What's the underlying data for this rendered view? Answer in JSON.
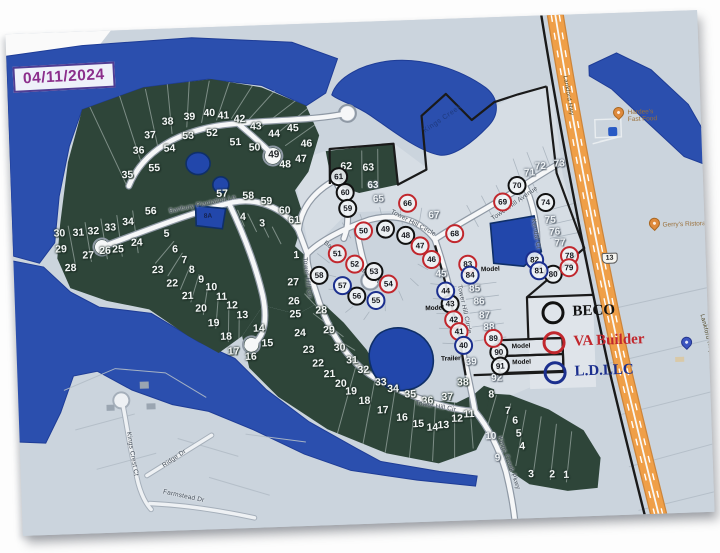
{
  "map": {
    "date_stamp": "04/11/2024",
    "colors": {
      "water": "#2b4fae",
      "forest": "#2e4539",
      "plat_light": "#d6dde4",
      "base": "#cbd4dd",
      "road": "#f6f7f8",
      "highway_orange": "#ef9f48",
      "boundary_black": "#1a1a1a",
      "beco": "#111111",
      "va_builder": "#c1272d",
      "ld_llc": "#1b2f8e",
      "date_stamp": "#8b2e8c"
    },
    "legend_colors": {
      "BECO": "#111111",
      "VA": "#c1272d",
      "LD": "#1b2f8e"
    },
    "legend_items": [
      {
        "label": "BECO",
        "color": "#111111"
      },
      {
        "label": "VA Builder",
        "color": "#c1272d"
      },
      {
        "label": "L.D.LLC",
        "color": "#1b2f8e"
      }
    ],
    "lot_labels": [
      {
        "n": "35",
        "x": 131,
        "y": 167
      },
      {
        "n": "36",
        "x": 143,
        "y": 143
      },
      {
        "n": "37",
        "x": 155,
        "y": 128
      },
      {
        "n": "38",
        "x": 173,
        "y": 115
      },
      {
        "n": "39",
        "x": 195,
        "y": 111
      },
      {
        "n": "40",
        "x": 215,
        "y": 108
      },
      {
        "n": "41",
        "x": 229,
        "y": 111
      },
      {
        "n": "42",
        "x": 245,
        "y": 115
      },
      {
        "n": "43",
        "x": 261,
        "y": 123
      },
      {
        "n": "44",
        "x": 279,
        "y": 131
      },
      {
        "n": "45",
        "x": 298,
        "y": 126
      },
      {
        "n": "46",
        "x": 311,
        "y": 142
      },
      {
        "n": "47",
        "x": 305,
        "y": 157
      },
      {
        "n": "48",
        "x": 289,
        "y": 162
      },
      {
        "n": "49",
        "x": 278,
        "y": 152,
        "cls": "dark"
      },
      {
        "n": "50",
        "x": 259,
        "y": 144
      },
      {
        "n": "51",
        "x": 240,
        "y": 138
      },
      {
        "n": "52",
        "x": 217,
        "y": 128
      },
      {
        "n": "53",
        "x": 193,
        "y": 130
      },
      {
        "n": "54",
        "x": 174,
        "y": 142
      },
      {
        "n": "55",
        "x": 158,
        "y": 161
      },
      {
        "n": "56",
        "x": 153,
        "y": 204
      },
      {
        "n": "57",
        "x": 225,
        "y": 189
      },
      {
        "n": "58",
        "x": 251,
        "y": 192
      },
      {
        "n": "59",
        "x": 269,
        "y": 198
      },
      {
        "n": "60",
        "x": 287,
        "y": 208
      },
      {
        "n": "61",
        "x": 296,
        "y": 218
      },
      {
        "n": "62",
        "x": 350,
        "y": 166
      },
      {
        "n": "63",
        "x": 372,
        "y": 168
      },
      {
        "n": "4",
        "x": 245,
        "y": 213
      },
      {
        "n": "3",
        "x": 264,
        "y": 220
      },
      {
        "n": "30",
        "x": 61,
        "y": 223
      },
      {
        "n": "31",
        "x": 80,
        "y": 223
      },
      {
        "n": "32",
        "x": 95,
        "y": 222
      },
      {
        "n": "33",
        "x": 112,
        "y": 219
      },
      {
        "n": "34",
        "x": 130,
        "y": 214
      },
      {
        "n": "29",
        "x": 62,
        "y": 239
      },
      {
        "n": "28",
        "x": 71,
        "y": 258
      },
      {
        "n": "27",
        "x": 89,
        "y": 246
      },
      {
        "n": "26",
        "x": 106,
        "y": 242
      },
      {
        "n": "25",
        "x": 119,
        "y": 241
      },
      {
        "n": "24",
        "x": 138,
        "y": 235
      },
      {
        "n": "5",
        "x": 168,
        "y": 227
      },
      {
        "n": "6",
        "x": 176,
        "y": 243
      },
      {
        "n": "7",
        "x": 185,
        "y": 254
      },
      {
        "n": "8",
        "x": 192,
        "y": 264
      },
      {
        "n": "9",
        "x": 201,
        "y": 274
      },
      {
        "n": "10",
        "x": 211,
        "y": 282
      },
      {
        "n": "11",
        "x": 221,
        "y": 292
      },
      {
        "n": "12",
        "x": 231,
        "y": 301
      },
      {
        "n": "13",
        "x": 241,
        "y": 311
      },
      {
        "n": "14",
        "x": 257,
        "y": 325
      },
      {
        "n": "15",
        "x": 265,
        "y": 340
      },
      {
        "n": "16",
        "x": 248,
        "y": 353
      },
      {
        "n": "23",
        "x": 158,
        "y": 263
      },
      {
        "n": "22",
        "x": 172,
        "y": 277
      },
      {
        "n": "21",
        "x": 187,
        "y": 290
      },
      {
        "n": "20",
        "x": 200,
        "y": 303
      },
      {
        "n": "19",
        "x": 212,
        "y": 318
      },
      {
        "n": "18",
        "x": 224,
        "y": 332
      },
      {
        "n": "17",
        "x": 231,
        "y": 347
      },
      {
        "n": "1",
        "x": 297,
        "y": 253
      },
      {
        "n": "27",
        "x": 293,
        "y": 280
      },
      {
        "n": "26",
        "x": 293,
        "y": 299
      },
      {
        "n": "25",
        "x": 294,
        "y": 312
      },
      {
        "n": "24",
        "x": 298,
        "y": 331
      },
      {
        "n": "23",
        "x": 306,
        "y": 348
      },
      {
        "n": "22",
        "x": 315,
        "y": 362
      },
      {
        "n": "21",
        "x": 326,
        "y": 373
      },
      {
        "n": "20",
        "x": 337,
        "y": 383
      },
      {
        "n": "19",
        "x": 347,
        "y": 391
      },
      {
        "n": "28",
        "x": 320,
        "y": 309
      },
      {
        "n": "29",
        "x": 327,
        "y": 329
      },
      {
        "n": "30",
        "x": 337,
        "y": 347
      },
      {
        "n": "31",
        "x": 349,
        "y": 360
      },
      {
        "n": "32",
        "x": 360,
        "y": 370
      },
      {
        "n": "33",
        "x": 377,
        "y": 383
      },
      {
        "n": "34",
        "x": 389,
        "y": 390
      },
      {
        "n": "35",
        "x": 406,
        "y": 396
      },
      {
        "n": "36",
        "x": 423,
        "y": 403
      },
      {
        "n": "37",
        "x": 443,
        "y": 400
      },
      {
        "n": "38",
        "x": 459,
        "y": 386
      },
      {
        "n": "18",
        "x": 360,
        "y": 401
      },
      {
        "n": "17",
        "x": 378,
        "y": 411
      },
      {
        "n": "16",
        "x": 397,
        "y": 419
      },
      {
        "n": "15",
        "x": 413,
        "y": 426
      },
      {
        "n": "14",
        "x": 427,
        "y": 430
      },
      {
        "n": "13",
        "x": 438,
        "y": 428
      },
      {
        "n": "12",
        "x": 452,
        "y": 422
      },
      {
        "n": "11",
        "x": 464,
        "y": 418
      },
      {
        "n": "63",
        "x": 376,
        "y": 186,
        "cls": "lt"
      },
      {
        "n": "65",
        "x": 381,
        "y": 200,
        "cls": "lt"
      },
      {
        "n": "67",
        "x": 436,
        "y": 218,
        "cls": "lt"
      },
      {
        "n": "45",
        "x": 441,
        "y": 277,
        "cls": "lt"
      },
      {
        "n": "71",
        "x": 533,
        "y": 179,
        "cls": "lt"
      },
      {
        "n": "72",
        "x": 544,
        "y": 173,
        "cls": "lt"
      },
      {
        "n": "73",
        "x": 563,
        "y": 171,
        "cls": "lt"
      },
      {
        "n": "75",
        "x": 552,
        "y": 227,
        "cls": "lt"
      },
      {
        "n": "76",
        "x": 556,
        "y": 239,
        "cls": "lt"
      },
      {
        "n": "77",
        "x": 561,
        "y": 250,
        "cls": "lt"
      },
      {
        "n": "85",
        "x": 474,
        "y": 293,
        "cls": "lt"
      },
      {
        "n": "86",
        "x": 478,
        "y": 306,
        "cls": "lt"
      },
      {
        "n": "87",
        "x": 483,
        "y": 320,
        "cls": "lt"
      },
      {
        "n": "88",
        "x": 487,
        "y": 332,
        "cls": "lt"
      },
      {
        "n": "92",
        "x": 493,
        "y": 383,
        "cls": "lt"
      },
      {
        "n": "39",
        "x": 468,
        "y": 366,
        "cls": "lt"
      },
      {
        "n": "10",
        "x": 485,
        "y": 441,
        "cls": "lt"
      },
      {
        "n": "9",
        "x": 491,
        "y": 463,
        "cls": "lt"
      },
      {
        "n": "8",
        "x": 487,
        "y": 399
      },
      {
        "n": "7",
        "x": 503,
        "y": 416
      },
      {
        "n": "6",
        "x": 510,
        "y": 426
      },
      {
        "n": "5",
        "x": 513,
        "y": 439
      },
      {
        "n": "4",
        "x": 516,
        "y": 452
      },
      {
        "n": "3",
        "x": 524,
        "y": 480
      },
      {
        "n": "2",
        "x": 545,
        "y": 481
      },
      {
        "n": "1",
        "x": 559,
        "y": 482
      }
    ],
    "builder_circles": [
      {
        "b": "BECO",
        "n": "61",
        "x": 342,
        "y": 176
      },
      {
        "b": "BECO",
        "n": "60",
        "x": 348,
        "y": 192
      },
      {
        "b": "BECO",
        "n": "59",
        "x": 350,
        "y": 208
      },
      {
        "b": "BECO",
        "n": "49",
        "x": 387,
        "y": 230
      },
      {
        "b": "BECO",
        "n": "48",
        "x": 407,
        "y": 237
      },
      {
        "b": "BECO",
        "n": "58",
        "x": 319,
        "y": 274
      },
      {
        "b": "BECO",
        "n": "53",
        "x": 374,
        "y": 272
      },
      {
        "b": "BECO",
        "n": "56",
        "x": 356,
        "y": 296
      },
      {
        "b": "BECO",
        "n": "43",
        "x": 449,
        "y": 307
      },
      {
        "b": "BECO",
        "n": "70",
        "x": 520,
        "y": 191
      },
      {
        "b": "BECO",
        "n": "74",
        "x": 548,
        "y": 209
      },
      {
        "b": "BECO",
        "n": "80",
        "x": 553,
        "y": 281
      },
      {
        "b": "BECO",
        "n": "90",
        "x": 496,
        "y": 357
      },
      {
        "b": "BECO",
        "n": "91",
        "x": 497,
        "y": 371
      },
      {
        "b": "VA",
        "n": "50",
        "x": 365,
        "y": 231
      },
      {
        "b": "VA",
        "n": "47",
        "x": 421,
        "y": 248
      },
      {
        "b": "VA",
        "n": "46",
        "x": 432,
        "y": 262
      },
      {
        "b": "VA",
        "n": "51",
        "x": 338,
        "y": 253
      },
      {
        "b": "VA",
        "n": "52",
        "x": 355,
        "y": 264
      },
      {
        "b": "VA",
        "n": "54",
        "x": 388,
        "y": 285
      },
      {
        "b": "VA",
        "n": "66",
        "x": 410,
        "y": 205
      },
      {
        "b": "VA",
        "n": "68",
        "x": 456,
        "y": 237
      },
      {
        "b": "VA",
        "n": "69",
        "x": 505,
        "y": 207
      },
      {
        "b": "VA",
        "n": "83",
        "x": 468,
        "y": 268
      },
      {
        "b": "VA",
        "n": "42",
        "x": 452,
        "y": 323
      },
      {
        "b": "VA",
        "n": "41",
        "x": 457,
        "y": 335
      },
      {
        "b": "VA",
        "n": "89",
        "x": 491,
        "y": 343
      },
      {
        "b": "VA",
        "n": "78",
        "x": 570,
        "y": 263
      },
      {
        "b": "VA",
        "n": "79",
        "x": 569,
        "y": 275
      },
      {
        "b": "LD",
        "n": "57",
        "x": 342,
        "y": 285
      },
      {
        "b": "LD",
        "n": "55",
        "x": 375,
        "y": 301
      },
      {
        "b": "LD",
        "n": "84",
        "x": 470,
        "y": 279
      },
      {
        "b": "LD",
        "n": "44",
        "x": 445,
        "y": 294
      },
      {
        "b": "LD",
        "n": "40",
        "x": 461,
        "y": 349
      },
      {
        "b": "LD",
        "n": "82",
        "x": 535,
        "y": 266
      },
      {
        "b": "LD",
        "n": "81",
        "x": 539,
        "y": 277
      }
    ],
    "street_labels": [
      {
        "text": "Banbury Plantation Ln",
        "x": 205,
        "y": 199,
        "rot": -10
      },
      {
        "text": "Banbury Plantation Ct",
        "x": 352,
        "y": 262,
        "rot": 38
      },
      {
        "text": "Tower Hill Circle",
        "x": 415,
        "y": 225,
        "rot": 30
      },
      {
        "text": "Tower Hill Circle",
        "x": 463,
        "y": 313,
        "rot": 80
      },
      {
        "text": "Tower Hill Cir",
        "x": 307,
        "y": 276,
        "rot": 85
      },
      {
        "text": "Tower Hill Cir",
        "x": 431,
        "y": 409,
        "rot": 12
      },
      {
        "text": "Tower Hill Avenue",
        "x": 517,
        "y": 209,
        "rot": -33
      },
      {
        "text": "Kendal Ct",
        "x": 537,
        "y": 240,
        "rot": 82
      },
      {
        "text": "Kings Creek Pkwy",
        "x": 502,
        "y": 468,
        "rot": 72
      },
      {
        "text": "Kings Crest Ct",
        "x": 126,
        "y": 446,
        "rot": 82
      },
      {
        "text": "Ridge Dr",
        "x": 168,
        "y": 452,
        "rot": -32
      },
      {
        "text": "Farmstead Dr",
        "x": 176,
        "y": 490,
        "rot": 14
      }
    ],
    "notes": [
      {
        "text": "Model",
        "x": 481,
        "y": 274
      },
      {
        "text": "Model",
        "x": 424,
        "y": 311
      },
      {
        "text": "Model",
        "x": 509,
        "y": 352
      },
      {
        "text": "Model",
        "x": 509,
        "y": 368
      },
      {
        "text": "Trailer",
        "x": 438,
        "y": 362
      }
    ],
    "water_labels": [
      {
        "text": "Kings Creek",
        "x": 448,
        "y": 122,
        "rot": -32
      }
    ],
    "pond_labels": [
      {
        "text": "8A",
        "x": 210,
        "y": 211
      }
    ],
    "highway": {
      "labels": [
        {
          "text": "Lankford Hwy",
          "x": 574,
          "y": 103,
          "rot": 82
        },
        {
          "text": "Lankford Hwy",
          "x": 704,
          "y": 346,
          "rot": 78
        }
      ],
      "shields": [
        {
          "text": "13",
          "x": 610,
          "y": 267
        }
      ]
    },
    "poi_pins": [
      {
        "x": 624,
        "y": 126,
        "pin": "orange"
      },
      {
        "x": 656,
        "y": 238,
        "pin": "orange"
      },
      {
        "x": 684,
        "y": 358,
        "pin": "blue"
      }
    ],
    "poi_labels": [
      {
        "text": "Hardee's\nFast Food",
        "x": 633,
        "y": 126
      },
      {
        "text": "Gerry's Ristorante",
        "x": 664,
        "y": 236
      }
    ]
  }
}
